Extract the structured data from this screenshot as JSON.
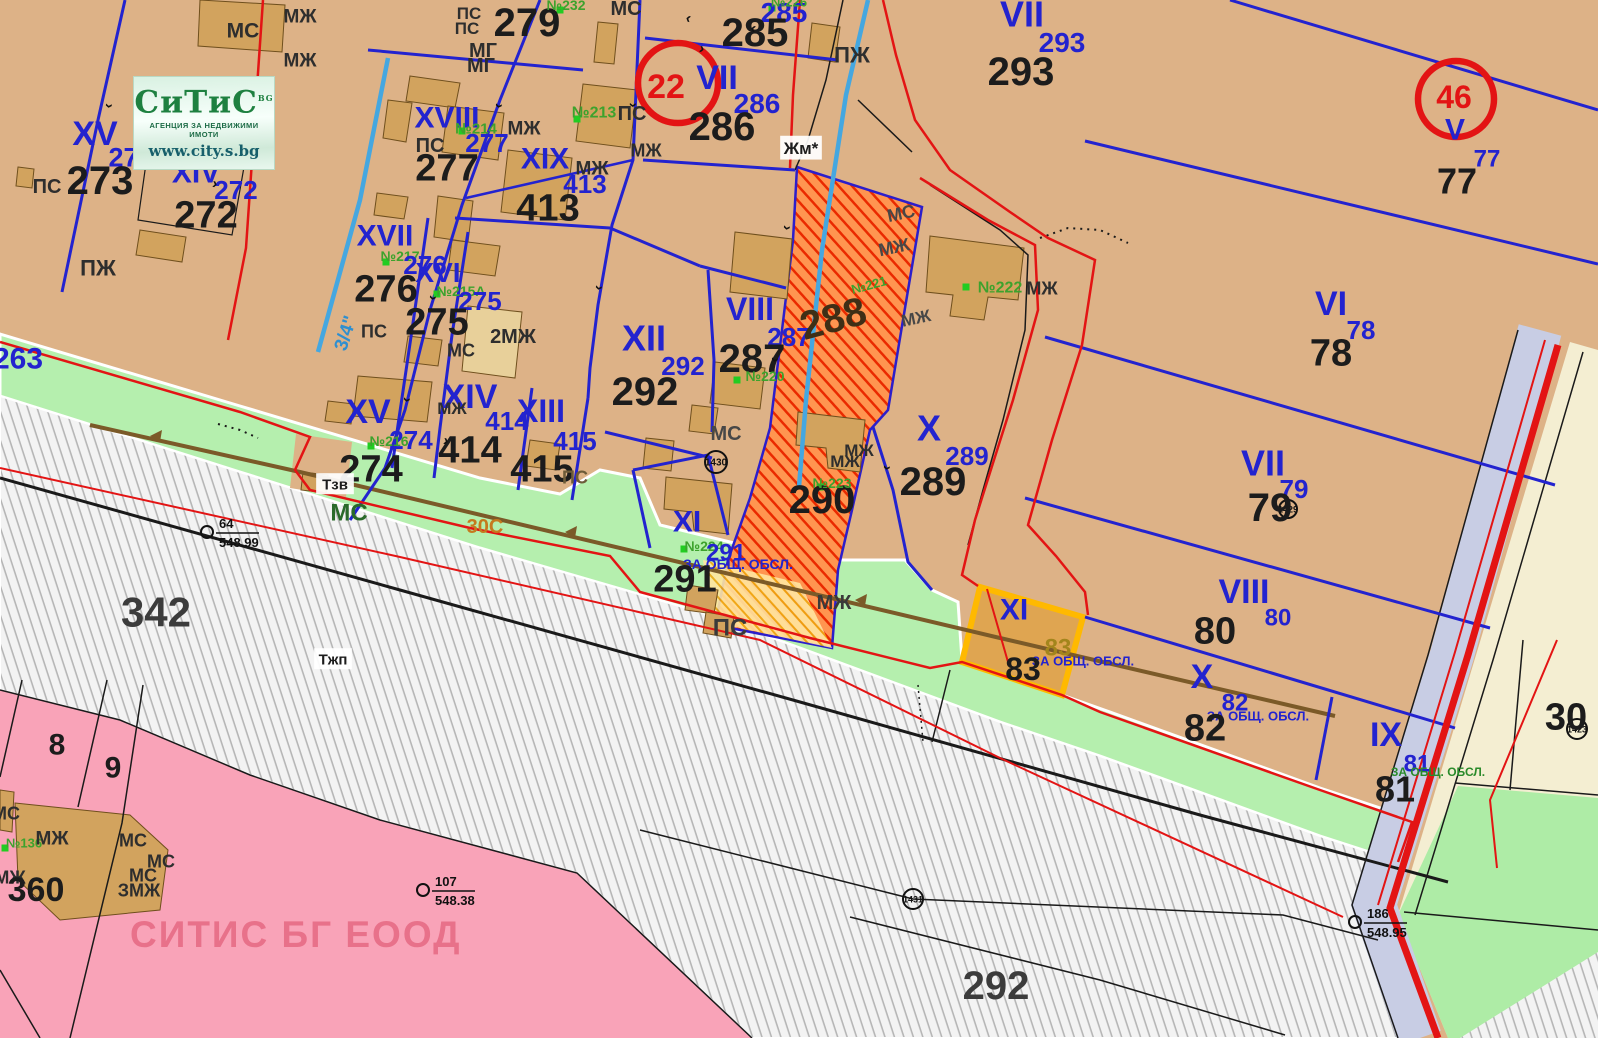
{
  "logo": {
    "brand": "СиТиС",
    "brand_suffix": "BG",
    "tagline": "АГЕНЦИЯ ЗА НЕДВИЖИМИ ИМОТИ",
    "url": "www.city.s.bg"
  },
  "watermark": "СИТИС БГ ЕООД",
  "palette": {
    "parcel_tan": "#ddb287",
    "building_tan": "#d2a35e",
    "green_strip": "#b5efae",
    "road_gray_hatch": "#b6b6b6",
    "pink_zone": "#f9a3b8",
    "regulation_blue": "#2323cf",
    "regulation_red": "#e31414",
    "hatch_parcel_red": "#ea2a00",
    "highlight_orange": "#ffb900",
    "water_blue": "#45a7e0",
    "lavender_road": "#c8cde4",
    "cream_zone": "#f4eed2",
    "watermark_pink": "#e8718a"
  },
  "red_circles": [
    {
      "t": "22",
      "x": 678,
      "y": 83,
      "r": 40,
      "tx": 666,
      "ty": 86,
      "ts": 34
    },
    {
      "t": "46",
      "x": 1456,
      "y": 99,
      "r": 38,
      "tx": 1454,
      "ty": 97,
      "ts": 32
    }
  ],
  "circles": [
    {
      "t": "1430",
      "x": 716,
      "y": 462,
      "r": 11
    },
    {
      "t": "1431",
      "x": 913,
      "y": 899,
      "r": 10
    },
    {
      "t": "1423",
      "x": 1577,
      "y": 729,
      "r": 10
    },
    {
      "t": "1429",
      "x": 1288,
      "y": 509,
      "r": 9
    }
  ],
  "benchmarks": [
    {
      "num": "64",
      "elev": "548.99",
      "x": 207,
      "y": 532
    },
    {
      "num": "107",
      "elev": "548.38",
      "x": 423,
      "y": 890
    },
    {
      "num": "186",
      "elev": "548.95",
      "x": 1355,
      "y": 922
    }
  ],
  "markers": [
    {
      "x": 207,
      "y": 160
    },
    {
      "x": 462,
      "y": 131
    },
    {
      "x": 577,
      "y": 119
    },
    {
      "x": 560,
      "y": 10
    },
    {
      "x": 772,
      "y": 8
    },
    {
      "x": 386,
      "y": 262
    },
    {
      "x": 437,
      "y": 294
    },
    {
      "x": 371,
      "y": 446
    },
    {
      "x": 737,
      "y": 380
    },
    {
      "x": 966,
      "y": 287
    },
    {
      "x": 820,
      "y": 487
    },
    {
      "x": 684,
      "y": 549
    },
    {
      "x": 5,
      "y": 848
    }
  ],
  "labels": [
    {
      "t": "МС",
      "x": 243,
      "y": 30,
      "s": 21,
      "c": "#2e2e2e"
    },
    {
      "t": "МЖ",
      "x": 300,
      "y": 16,
      "s": 19,
      "c": "#2e2e2e"
    },
    {
      "t": "МЖ",
      "x": 300,
      "y": 60,
      "s": 19,
      "c": "#2e2e2e"
    },
    {
      "t": "263",
      "x": 18,
      "y": 358,
      "s": 30,
      "c": "#2323cf"
    },
    {
      "t": "XV",
      "x": 95,
      "y": 133,
      "s": 34,
      "c": "#2323cf"
    },
    {
      "t": "273",
      "x": 131,
      "y": 157,
      "s": 27,
      "c": "#2323cf"
    },
    {
      "t": "ПС",
      "x": 47,
      "y": 186,
      "s": 20,
      "c": "#2e2e2e"
    },
    {
      "t": "273",
      "x": 100,
      "y": 180,
      "s": 40,
      "c": "#1c1c1c"
    },
    {
      "t": "XIV",
      "x": 196,
      "y": 172,
      "s": 30,
      "c": "#2323cf"
    },
    {
      "t": "№215",
      "x": 250,
      "y": 155,
      "s": 16,
      "c": "#3da22d"
    },
    {
      "t": "272",
      "x": 236,
      "y": 190,
      "s": 26,
      "c": "#2323cf"
    },
    {
      "t": "272",
      "x": 206,
      "y": 214,
      "s": 38,
      "c": "#1c1c1c"
    },
    {
      "t": "ПЖ",
      "x": 98,
      "y": 268,
      "s": 22,
      "c": "#2e2e2e"
    },
    {
      "t": "XVIII",
      "x": 447,
      "y": 117,
      "s": 30,
      "c": "#2323cf"
    },
    {
      "t": "№214",
      "x": 476,
      "y": 128,
      "s": 15,
      "c": "#3da22d"
    },
    {
      "t": "277",
      "x": 487,
      "y": 143,
      "s": 26,
      "c": "#2323cf"
    },
    {
      "t": "ПС",
      "x": 430,
      "y": 145,
      "s": 20,
      "c": "#2e2e2e"
    },
    {
      "t": "277",
      "x": 447,
      "y": 167,
      "s": 38,
      "c": "#1c1c1c"
    },
    {
      "t": "МГ",
      "x": 483,
      "y": 50,
      "s": 20,
      "c": "#2e2e2e"
    },
    {
      "t": "МГ",
      "x": 481,
      "y": 65,
      "s": 20,
      "c": "#2e2e2e"
    },
    {
      "t": "279",
      "x": 527,
      "y": 22,
      "s": 40,
      "c": "#1c1c1c"
    },
    {
      "t": "ПС",
      "x": 469,
      "y": 13,
      "s": 17,
      "c": "#2e2e2e"
    },
    {
      "t": "ПС",
      "x": 467,
      "y": 28,
      "s": 17,
      "c": "#2e2e2e"
    },
    {
      "t": "№232",
      "x": 566,
      "y": 5,
      "s": 14,
      "c": "#3da22d"
    },
    {
      "t": "МС",
      "x": 626,
      "y": 8,
      "s": 20,
      "c": "#2e2e2e"
    },
    {
      "t": "XIX",
      "x": 545,
      "y": 158,
      "s": 30,
      "c": "#2323cf"
    },
    {
      "t": "№213",
      "x": 594,
      "y": 112,
      "s": 16,
      "c": "#3da22d"
    },
    {
      "t": "ПС",
      "x": 632,
      "y": 113,
      "s": 20,
      "c": "#2e2e2e"
    },
    {
      "t": "МЖ",
      "x": 524,
      "y": 128,
      "s": 19,
      "c": "#2e2e2e"
    },
    {
      "t": "МЖ",
      "x": 592,
      "y": 168,
      "s": 19,
      "c": "#2e2e2e"
    },
    {
      "t": "413",
      "x": 585,
      "y": 184,
      "s": 26,
      "c": "#2323cf"
    },
    {
      "t": "413",
      "x": 548,
      "y": 207,
      "s": 38,
      "c": "#1c1c1c"
    },
    {
      "t": "XVII",
      "x": 385,
      "y": 235,
      "s": 30,
      "c": "#2323cf"
    },
    {
      "t": "№217",
      "x": 400,
      "y": 256,
      "s": 14,
      "c": "#3da22d"
    },
    {
      "t": "276",
      "x": 425,
      "y": 265,
      "s": 26,
      "c": "#2323cf"
    },
    {
      "t": "276",
      "x": 386,
      "y": 288,
      "s": 38,
      "c": "#1c1c1c"
    },
    {
      "t": "XVI",
      "x": 438,
      "y": 272,
      "s": 28,
      "c": "#2323cf"
    },
    {
      "t": "№215А",
      "x": 461,
      "y": 291,
      "s": 14,
      "c": "#3da22d"
    },
    {
      "t": "275",
      "x": 480,
      "y": 301,
      "s": 26,
      "c": "#2323cf"
    },
    {
      "t": "275",
      "x": 437,
      "y": 321,
      "s": 38,
      "c": "#1c1c1c"
    },
    {
      "t": "2МЖ",
      "x": 513,
      "y": 336,
      "s": 20,
      "c": "#2e2e2e"
    },
    {
      "t": "ПС",
      "x": 374,
      "y": 331,
      "s": 18,
      "c": "#2e2e2e"
    },
    {
      "t": "МС",
      "x": 461,
      "y": 350,
      "s": 18,
      "c": "#2e2e2e"
    },
    {
      "t": "XV",
      "x": 368,
      "y": 411,
      "s": 34,
      "c": "#2323cf"
    },
    {
      "t": "XIV",
      "x": 470,
      "y": 396,
      "s": 34,
      "c": "#2323cf"
    },
    {
      "t": "МЖ",
      "x": 452,
      "y": 408,
      "s": 17,
      "c": "#2e2e2e"
    },
    {
      "t": "XIII",
      "x": 541,
      "y": 411,
      "s": 32,
      "c": "#2323cf"
    },
    {
      "t": "414",
      "x": 507,
      "y": 421,
      "s": 26,
      "c": "#2323cf"
    },
    {
      "t": "414",
      "x": 470,
      "y": 449,
      "s": 38,
      "c": "#1c1c1c"
    },
    {
      "t": "415",
      "x": 575,
      "y": 441,
      "s": 26,
      "c": "#2323cf"
    },
    {
      "t": "415",
      "x": 542,
      "y": 468,
      "s": 38,
      "c": "#1c1c1c"
    },
    {
      "t": "ПС",
      "x": 575,
      "y": 477,
      "s": 18,
      "c": "#6d5b39"
    },
    {
      "t": "274",
      "x": 411,
      "y": 440,
      "s": 26,
      "c": "#2323cf"
    },
    {
      "t": "№216",
      "x": 389,
      "y": 441,
      "s": 14,
      "c": "#3da22d"
    },
    {
      "t": "274",
      "x": 371,
      "y": 468,
      "s": 38,
      "c": "#1c1c1c"
    },
    {
      "t": "Тзв",
      "x": 335,
      "y": 484,
      "s": 15,
      "c": "#1c1c1c",
      "bg": true
    },
    {
      "t": "МС",
      "x": 349,
      "y": 512,
      "s": 24,
      "c": "#2a6a2a"
    },
    {
      "t": "30С",
      "x": 485,
      "y": 526,
      "s": 20,
      "c": "#c57a1e"
    },
    {
      "t": "342",
      "x": 156,
      "y": 612,
      "s": 42,
      "c": "#3c3c3c"
    },
    {
      "t": "Тжп",
      "x": 333,
      "y": 659,
      "s": 15,
      "c": "#1c1c1c",
      "bg": true
    },
    {
      "t": "VII",
      "x": 717,
      "y": 77,
      "s": 34,
      "c": "#2323cf"
    },
    {
      "t": "285",
      "x": 784,
      "y": 12,
      "s": 28,
      "c": "#2323cf"
    },
    {
      "t": "№226",
      "x": 789,
      "y": 2,
      "s": 13,
      "c": "#3da22d"
    },
    {
      "t": "285",
      "x": 755,
      "y": 32,
      "s": 40,
      "c": "#1c1c1c"
    },
    {
      "t": "286",
      "x": 757,
      "y": 103,
      "s": 28,
      "c": "#2323cf"
    },
    {
      "t": "286",
      "x": 722,
      "y": 126,
      "s": 40,
      "c": "#1c1c1c"
    },
    {
      "t": "ПЖ",
      "x": 852,
      "y": 55,
      "s": 22,
      "c": "#2e2e2e"
    },
    {
      "t": "Жм*",
      "x": 801,
      "y": 148,
      "s": 17,
      "c": "#1c1c1c",
      "bg": true
    },
    {
      "t": "МЖ",
      "x": 646,
      "y": 150,
      "s": 18,
      "c": "#2e2e2e"
    },
    {
      "t": "VII",
      "x": 1022,
      "y": 14,
      "s": 36,
      "c": "#2323cf"
    },
    {
      "t": "293",
      "x": 1062,
      "y": 42,
      "s": 28,
      "c": "#2323cf"
    },
    {
      "t": "293",
      "x": 1021,
      "y": 71,
      "s": 40,
      "c": "#1c1c1c"
    },
    {
      "t": "V",
      "x": 1455,
      "y": 129,
      "s": 30,
      "c": "#2323cf"
    },
    {
      "t": "77",
      "x": 1487,
      "y": 158,
      "s": 24,
      "c": "#2323cf"
    },
    {
      "t": "77",
      "x": 1457,
      "y": 181,
      "s": 36,
      "c": "#1c1c1c"
    },
    {
      "t": "XII",
      "x": 644,
      "y": 338,
      "s": 36,
      "c": "#2323cf"
    },
    {
      "t": "292",
      "x": 683,
      "y": 366,
      "s": 26,
      "c": "#2323cf"
    },
    {
      "t": "292",
      "x": 645,
      "y": 391,
      "s": 40,
      "c": "#1c1c1c"
    },
    {
      "t": "VIII",
      "x": 750,
      "y": 309,
      "s": 32,
      "c": "#2323cf"
    },
    {
      "t": "287",
      "x": 789,
      "y": 337,
      "s": 26,
      "c": "#2323cf"
    },
    {
      "t": "287",
      "x": 752,
      "y": 358,
      "s": 40,
      "c": "#1c1c1c"
    },
    {
      "t": "№220",
      "x": 765,
      "y": 376,
      "s": 14,
      "c": "#3da22d"
    },
    {
      "t": "288",
      "x": 833,
      "y": 318,
      "s": 40,
      "c": "#3f2f16",
      "r": -15
    },
    {
      "t": "№221",
      "x": 869,
      "y": 285,
      "s": 13,
      "c": "#3da22d",
      "r": -15
    },
    {
      "t": "МС",
      "x": 901,
      "y": 213,
      "s": 18,
      "c": "#474747",
      "r": -12
    },
    {
      "t": "МЖ",
      "x": 894,
      "y": 247,
      "s": 18,
      "c": "#474747",
      "r": -12
    },
    {
      "t": "МЖ",
      "x": 916,
      "y": 318,
      "s": 17,
      "c": "#474747",
      "r": -12
    },
    {
      "t": "X",
      "x": 929,
      "y": 428,
      "s": 36,
      "c": "#2323cf"
    },
    {
      "t": "289",
      "x": 967,
      "y": 456,
      "s": 26,
      "c": "#2323cf"
    },
    {
      "t": "289",
      "x": 933,
      "y": 481,
      "s": 40,
      "c": "#1c1c1c"
    },
    {
      "t": "№222",
      "x": 1000,
      "y": 287,
      "s": 16,
      "c": "#3da22d"
    },
    {
      "t": "МЖ",
      "x": 1042,
      "y": 288,
      "s": 18,
      "c": "#2e2e2e"
    },
    {
      "t": "290",
      "x": 822,
      "y": 499,
      "s": 40,
      "c": "#1c1c1c"
    },
    {
      "t": "№223",
      "x": 832,
      "y": 483,
      "s": 14,
      "c": "#3da22d"
    },
    {
      "t": "МЖ",
      "x": 859,
      "y": 450,
      "s": 17,
      "c": "#2e2e2e"
    },
    {
      "t": "МЖ",
      "x": 845,
      "y": 461,
      "s": 17,
      "c": "#2e2e2e"
    },
    {
      "t": "МС",
      "x": 726,
      "y": 433,
      "s": 20,
      "c": "#474747"
    },
    {
      "t": "XI",
      "x": 687,
      "y": 521,
      "s": 30,
      "c": "#2323cf"
    },
    {
      "t": "№224",
      "x": 704,
      "y": 546,
      "s": 14,
      "c": "#3da22d"
    },
    {
      "t": "291",
      "x": 726,
      "y": 552,
      "s": 24,
      "c": "#2323cf"
    },
    {
      "t": "ЗА ОБЩ. ОБСЛ.",
      "x": 738,
      "y": 564,
      "s": 14,
      "c": "#2323cf"
    },
    {
      "t": "291",
      "x": 685,
      "y": 578,
      "s": 38,
      "c": "#1c1c1c"
    },
    {
      "t": "ПС",
      "x": 730,
      "y": 627,
      "s": 24,
      "c": "#3a3a3a"
    },
    {
      "t": "МЖ",
      "x": 834,
      "y": 602,
      "s": 20,
      "c": "#3a3a3a"
    },
    {
      "t": "VI",
      "x": 1331,
      "y": 303,
      "s": 34,
      "c": "#2323cf"
    },
    {
      "t": "78",
      "x": 1361,
      "y": 330,
      "s": 26,
      "c": "#2323cf"
    },
    {
      "t": "78",
      "x": 1331,
      "y": 352,
      "s": 38,
      "c": "#1c1c1c"
    },
    {
      "t": "VII",
      "x": 1263,
      "y": 463,
      "s": 36,
      "c": "#2323cf"
    },
    {
      "t": "79",
      "x": 1294,
      "y": 489,
      "s": 26,
      "c": "#2323cf"
    },
    {
      "t": "79",
      "x": 1270,
      "y": 507,
      "s": 40,
      "c": "#1c1c1c"
    },
    {
      "t": "VIII",
      "x": 1244,
      "y": 591,
      "s": 34,
      "c": "#2323cf"
    },
    {
      "t": "80",
      "x": 1278,
      "y": 617,
      "s": 24,
      "c": "#2323cf"
    },
    {
      "t": "80",
      "x": 1215,
      "y": 630,
      "s": 38,
      "c": "#1c1c1c"
    },
    {
      "t": "X",
      "x": 1202,
      "y": 676,
      "s": 34,
      "c": "#2323cf"
    },
    {
      "t": "82",
      "x": 1235,
      "y": 702,
      "s": 24,
      "c": "#2323cf"
    },
    {
      "t": "ЗА ОБЩ. ОБСЛ.",
      "x": 1258,
      "y": 716,
      "s": 13,
      "c": "#2323cf"
    },
    {
      "t": "82",
      "x": 1205,
      "y": 727,
      "s": 38,
      "c": "#1c1c1c"
    },
    {
      "t": "IX",
      "x": 1386,
      "y": 734,
      "s": 34,
      "c": "#2323cf"
    },
    {
      "t": "81",
      "x": 1417,
      "y": 763,
      "s": 24,
      "c": "#2323cf"
    },
    {
      "t": "81",
      "x": 1395,
      "y": 789,
      "s": 36,
      "c": "#1c1c1c"
    },
    {
      "t": "ЗА ОБЩ. ОБСЛ.",
      "x": 1438,
      "y": 772,
      "s": 12,
      "c": "#2a8a2a"
    },
    {
      "t": "XI",
      "x": 1014,
      "y": 609,
      "s": 30,
      "c": "#2323cf"
    },
    {
      "t": "83",
      "x": 1058,
      "y": 647,
      "s": 24,
      "c": "#a3851c"
    },
    {
      "t": "ЗА ОБЩ. ОБСЛ.",
      "x": 1083,
      "y": 661,
      "s": 13,
      "c": "#2323cf"
    },
    {
      "t": "83",
      "x": 1023,
      "y": 669,
      "s": 32,
      "c": "#1c1c1c"
    },
    {
      "t": "8",
      "x": 57,
      "y": 744,
      "s": 30,
      "c": "#1c1c1c"
    },
    {
      "t": "9",
      "x": 113,
      "y": 767,
      "s": 30,
      "c": "#1c1c1c"
    },
    {
      "t": "МС",
      "x": 6,
      "y": 813,
      "s": 18,
      "c": "#2e2e2e"
    },
    {
      "t": "№136",
      "x": 24,
      "y": 843,
      "s": 13,
      "c": "#3da22d"
    },
    {
      "t": "МЖ",
      "x": 52,
      "y": 838,
      "s": 19,
      "c": "#2e2e2e"
    },
    {
      "t": "МЖ",
      "x": 10,
      "y": 877,
      "s": 18,
      "c": "#2e2e2e"
    },
    {
      "t": "360",
      "x": 36,
      "y": 889,
      "s": 34,
      "c": "#1c1c1c"
    },
    {
      "t": "МС",
      "x": 133,
      "y": 840,
      "s": 18,
      "c": "#2e2e2e"
    },
    {
      "t": "МС",
      "x": 161,
      "y": 861,
      "s": 18,
      "c": "#2e2e2e"
    },
    {
      "t": "МС",
      "x": 143,
      "y": 875,
      "s": 18,
      "c": "#2e2e2e"
    },
    {
      "t": "ЗМЖ",
      "x": 139,
      "y": 890,
      "s": 18,
      "c": "#2e2e2e"
    },
    {
      "t": "292",
      "x": 996,
      "y": 985,
      "s": 40,
      "c": "#3c3c3c"
    },
    {
      "t": "30",
      "x": 1566,
      "y": 716,
      "s": 38,
      "c": "#1c1c1c"
    },
    {
      "t": "3/4\"",
      "x": 345,
      "y": 333,
      "s": 19,
      "c": "#2f8fd0",
      "r": -72
    },
    {
      "t": "›",
      "x": 110,
      "y": 106,
      "s": 15,
      "c": "#111111",
      "r": 97
    },
    {
      "t": "›",
      "x": 500,
      "y": 106,
      "s": 15,
      "c": "#111111",
      "r": 100
    },
    {
      "t": "›",
      "x": 434,
      "y": 298,
      "s": 15,
      "c": "#111111",
      "r": 100
    },
    {
      "t": "›",
      "x": 408,
      "y": 400,
      "s": 15,
      "c": "#111111",
      "r": 100
    },
    {
      "t": "›",
      "x": 634,
      "y": 105,
      "s": 15,
      "c": "#111111",
      "r": 92
    },
    {
      "t": "›",
      "x": 600,
      "y": 288,
      "s": 15,
      "c": "#111111",
      "r": 100
    },
    {
      "t": "›",
      "x": 688,
      "y": 20,
      "s": 15,
      "c": "#111111",
      "r": 195
    },
    {
      "t": "›",
      "x": 753,
      "y": 30,
      "s": 15,
      "c": "#111111",
      "r": 195
    },
    {
      "t": "›",
      "x": 702,
      "y": 48,
      "s": 15,
      "c": "#111111",
      "r": 15
    },
    {
      "t": "›",
      "x": 788,
      "y": 228,
      "s": 15,
      "c": "#111111",
      "r": 100
    },
    {
      "t": "›",
      "x": 776,
      "y": 360,
      "s": 15,
      "c": "#111111",
      "r": 100
    },
    {
      "t": "›",
      "x": 888,
      "y": 468,
      "s": 15,
      "c": "#111111",
      "r": 100
    },
    {
      "t": "›",
      "x": 215,
      "y": 183,
      "s": 15,
      "c": "#111111",
      "r": 10
    },
    {
      "t": "›",
      "x": 446,
      "y": 440,
      "s": 15,
      "c": "#111111",
      "r": 12
    }
  ]
}
